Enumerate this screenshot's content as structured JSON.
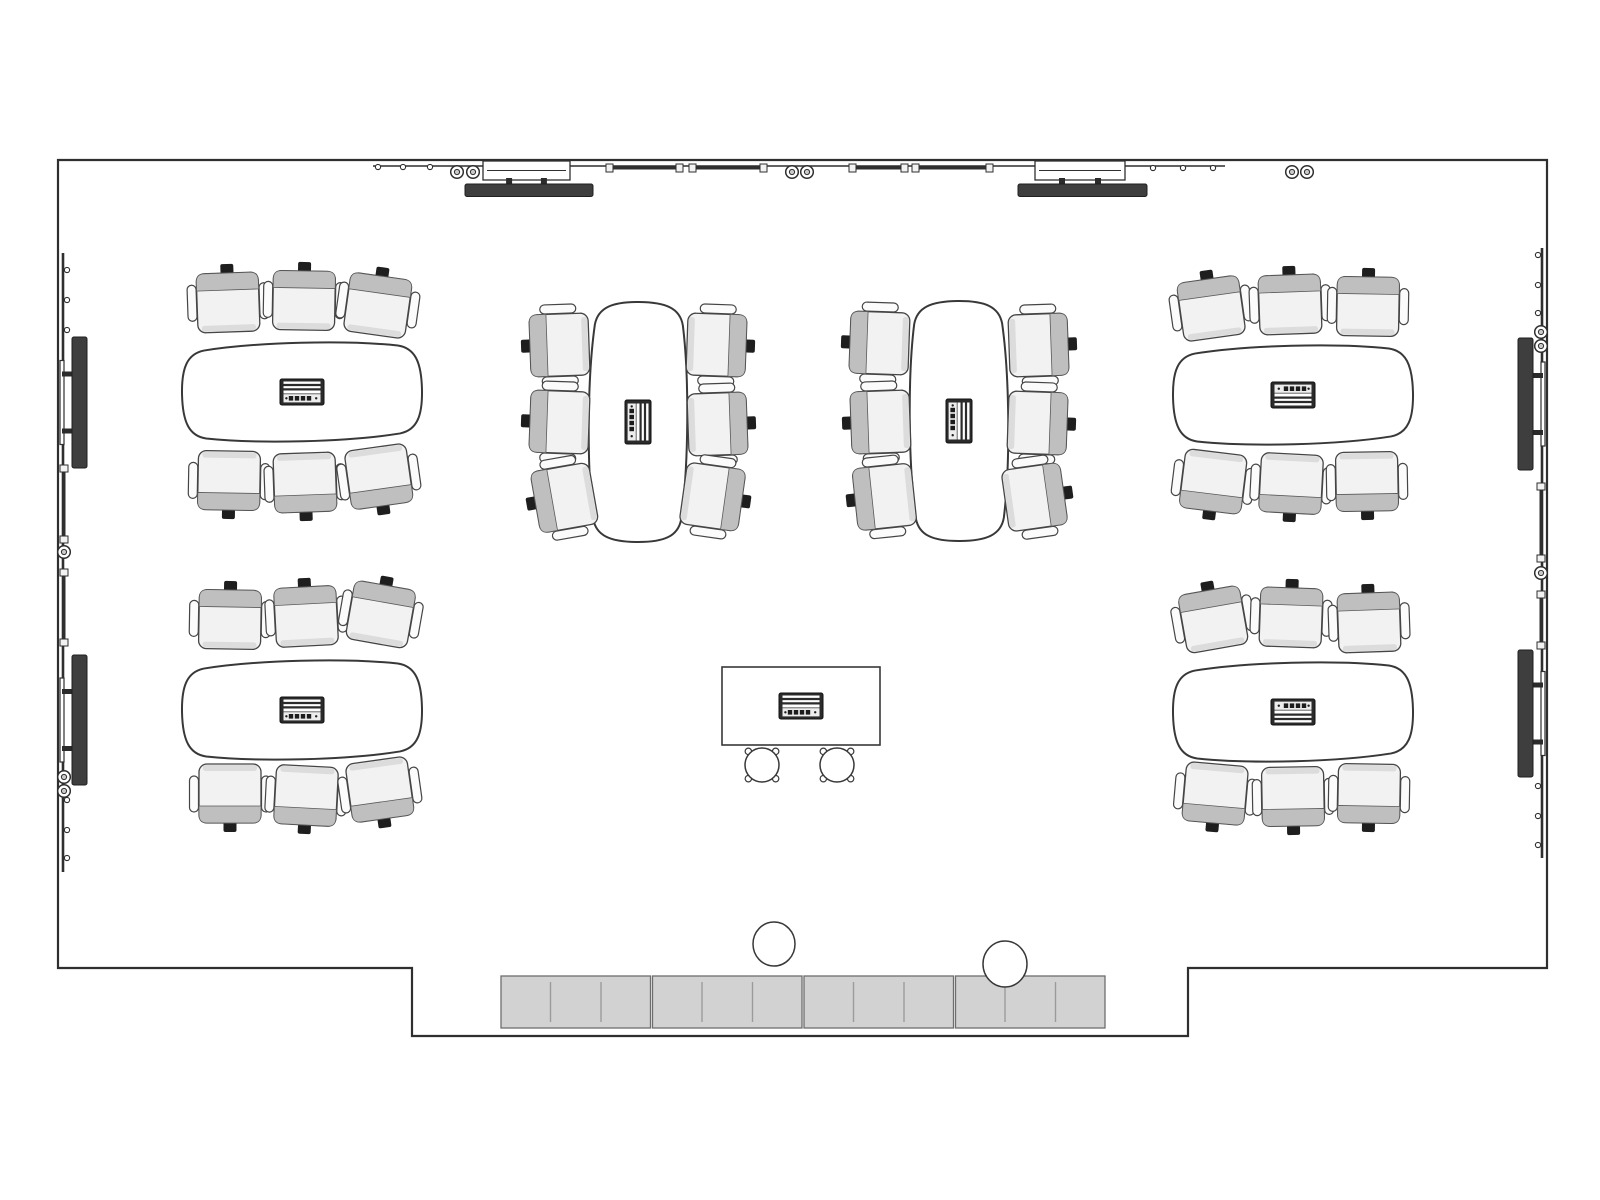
{
  "title": "Meeting room floor plan (plan view)",
  "canvas": {
    "width": 1600,
    "height": 1200,
    "background": "#ffffff"
  },
  "colors": {
    "wall": "#2f2f2f",
    "line": "#454545",
    "chair_fill": "#f2f2f2",
    "chair_back": "#bfbfbf",
    "chair_front": "#dcdcdc",
    "chair_tab": "#1e1e1e",
    "chair_arm": "#fbfbfb",
    "table_fill": "#ffffff",
    "table_line": "#383838",
    "display_fill": "#3e3e3e",
    "credenza_fill": "#d2d2d2",
    "credenza_line": "#9b9b9b",
    "credenza_border": "#6e6e6e",
    "module_dark": "#2b2b2b",
    "module_light": "#ededed"
  },
  "room": {
    "outline": [
      [
        58,
        160
      ],
      [
        1547,
        160
      ],
      [
        1547,
        968
      ],
      [
        1188,
        968
      ],
      [
        1188,
        1036
      ],
      [
        412,
        1036
      ],
      [
        412,
        968
      ],
      [
        58,
        968
      ]
    ]
  },
  "top_wall": {
    "rail": {
      "x1": 373,
      "x2": 1225,
      "y": 166
    },
    "studs": [
      [
        378,
        167
      ],
      [
        403,
        167
      ],
      [
        430,
        167
      ],
      [
        1153,
        168
      ],
      [
        1183,
        168
      ],
      [
        1213,
        168
      ]
    ],
    "speakers": [
      [
        457,
        172
      ],
      [
        473,
        172
      ],
      [
        792,
        172
      ],
      [
        807,
        172
      ],
      [
        1292,
        172
      ],
      [
        1307,
        172
      ]
    ],
    "tray_y": 168,
    "trays": [
      [
        607,
        682
      ],
      [
        690,
        766
      ],
      [
        850,
        907
      ],
      [
        913,
        992
      ]
    ],
    "displays": [
      {
        "bracket_x": 483,
        "bracket_w": 87,
        "bar_x": 465,
        "bar_w": 128
      },
      {
        "bracket_x": 1035,
        "bracket_w": 90,
        "bar_x": 1018,
        "bar_w": 129
      }
    ]
  },
  "left_wall": {
    "wall_x": 58,
    "dir": 1,
    "rail": [
      253,
      872
    ],
    "studs": [
      270,
      300,
      330,
      800,
      830,
      858
    ],
    "speakers": [
      552,
      777,
      791
    ],
    "trays": [
      [
        466,
        542
      ],
      [
        570,
        645
      ]
    ],
    "displays": [
      {
        "bar_y": 337,
        "bar_h": 131
      },
      {
        "bar_y": 655,
        "bar_h": 130
      }
    ]
  },
  "right_wall": {
    "wall_x": 1547,
    "dir": -1,
    "rail": [
      248,
      858
    ],
    "studs": [
      255,
      285,
      313,
      786,
      816,
      845
    ],
    "speakers": [
      332,
      346,
      573
    ],
    "trays": [
      [
        484,
        561
      ],
      [
        592,
        648
      ]
    ],
    "displays": [
      {
        "bar_y": 338,
        "bar_h": 132
      },
      {
        "bar_y": 650,
        "bar_h": 127
      }
    ]
  },
  "table_groups": [
    {
      "name": "table-group-top-left",
      "orient": "h",
      "cx": 302,
      "cy": 392,
      "tilt": -1.5,
      "module_rot": 0,
      "chairs": [
        [
          -74,
          -91,
          -2
        ],
        [
          2,
          -93,
          1
        ],
        [
          76,
          -88,
          8
        ],
        [
          -73,
          90,
          181
        ],
        [
          3,
          92,
          178
        ],
        [
          77,
          86,
          172
        ]
      ]
    },
    {
      "name": "table-group-bottom-left",
      "orient": "h",
      "cx": 302,
      "cy": 710,
      "tilt": -1.5,
      "module_rot": 0,
      "chairs": [
        [
          -72,
          -92,
          1
        ],
        [
          4,
          -95,
          -3
        ],
        [
          79,
          -97,
          10
        ],
        [
          -72,
          85,
          180
        ],
        [
          4,
          87,
          183
        ],
        [
          78,
          81,
          172
        ]
      ]
    },
    {
      "name": "table-group-top-right",
      "orient": "h",
      "cx": 1293,
      "cy": 395,
      "tilt": -1.5,
      "module_rot": 180,
      "chairs": [
        [
          -82,
          -88,
          -8
        ],
        [
          -3,
          -92,
          -2
        ],
        [
          75,
          -90,
          1
        ],
        [
          -80,
          88,
          187
        ],
        [
          -2,
          90,
          183
        ],
        [
          74,
          88,
          179
        ]
      ]
    },
    {
      "name": "table-group-bottom-right",
      "orient": "h",
      "cx": 1293,
      "cy": 712,
      "tilt": -1.5,
      "module_rot": 180,
      "chairs": [
        [
          -80,
          -94,
          -10
        ],
        [
          -2,
          -96,
          2
        ],
        [
          76,
          -91,
          -2
        ],
        [
          -78,
          83,
          185
        ],
        [
          0,
          86,
          179
        ],
        [
          76,
          83,
          181
        ]
      ]
    },
    {
      "name": "table-group-center-left",
      "orient": "v",
      "cx": 638,
      "cy": 422,
      "tilt": 0.5,
      "module_rot": 90,
      "chairs": [
        [
          -80,
          -77,
          268
        ],
        [
          -80,
          0,
          272
        ],
        [
          -75,
          76,
          260
        ],
        [
          80,
          -77,
          92
        ],
        [
          81,
          2,
          88
        ],
        [
          76,
          75,
          98
        ]
      ]
    },
    {
      "name": "table-group-center-right",
      "orient": "v",
      "cx": 959,
      "cy": 421,
      "tilt": -0.5,
      "module_rot": 90,
      "chairs": [
        [
          -81,
          -78,
          272
        ],
        [
          -80,
          1,
          268
        ],
        [
          -76,
          76,
          264
        ],
        [
          81,
          -76,
          88
        ],
        [
          80,
          2,
          92
        ],
        [
          77,
          76,
          82
        ]
      ]
    }
  ],
  "demo_table": {
    "x": 722,
    "y": 667,
    "w": 158,
    "h": 78,
    "module_cx": 801,
    "module_cy": 706,
    "stools": [
      [
        762,
        765
      ],
      [
        837,
        765
      ]
    ],
    "stool_r": 17
  },
  "credenza": {
    "x": 500,
    "y": 976,
    "w": 606,
    "h": 52,
    "sections": 4,
    "doors_per_section": 3
  },
  "bins": [
    [
      774,
      944,
      21,
      22
    ],
    [
      1005,
      964,
      22,
      23
    ]
  ]
}
